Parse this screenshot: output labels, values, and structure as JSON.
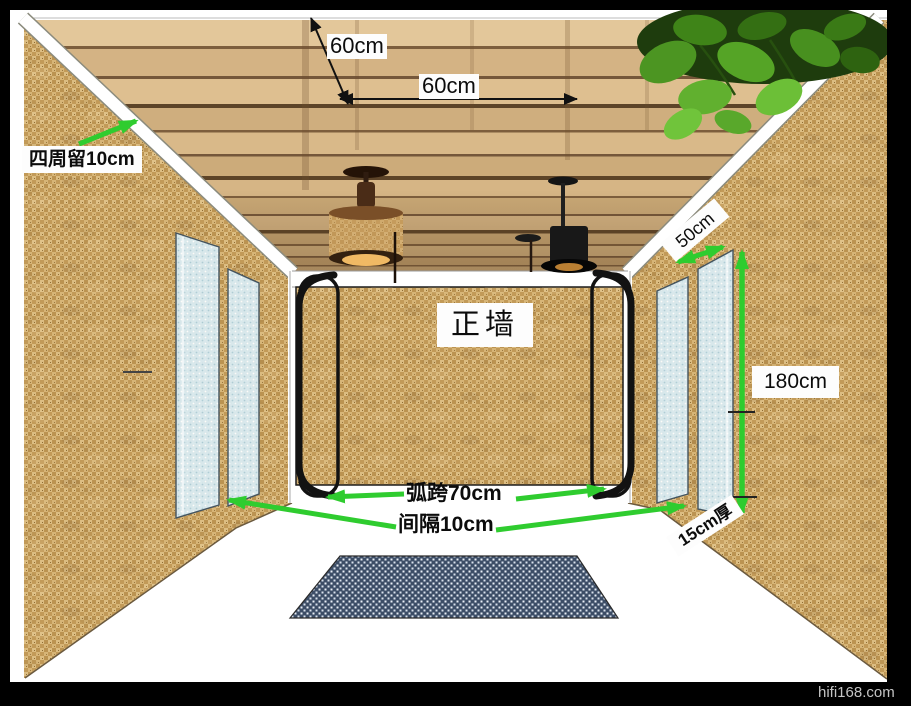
{
  "frame": {
    "watermark": "hifi168.com"
  },
  "labels": {
    "joist_depth_spacing": "60cm",
    "joist_width_spacing": "60cm",
    "perimeter_gap": "四周留10cm",
    "panel_top_offset": "50cm",
    "panel_height": "180cm",
    "front_wall": "正墙",
    "arc_span": "弧跨70cm",
    "panel_gap": "间隔10cm",
    "panel_thickness": "15cm厚"
  },
  "colors": {
    "annotation_green": "#2fcc2f",
    "dimension_black": "#111111",
    "burlap_wall": "#cfa868",
    "wood_ceiling": "#d8b88a",
    "panel_blue": "#d9ebf2",
    "mat_navy": "#3c4d66",
    "frame_black": "#000000"
  },
  "scene_objects": [
    "wood-slat-ceiling",
    "burlap-left-wall",
    "burlap-right-wall",
    "burlap-front-wall",
    "white-perimeter-bands",
    "corner-arc-left",
    "corner-arc-right",
    "acoustic-panels-left",
    "acoustic-panels-right",
    "woven-pendant-lamp",
    "black-pendant-lamp",
    "hanging-plant",
    "floor-mat"
  ]
}
